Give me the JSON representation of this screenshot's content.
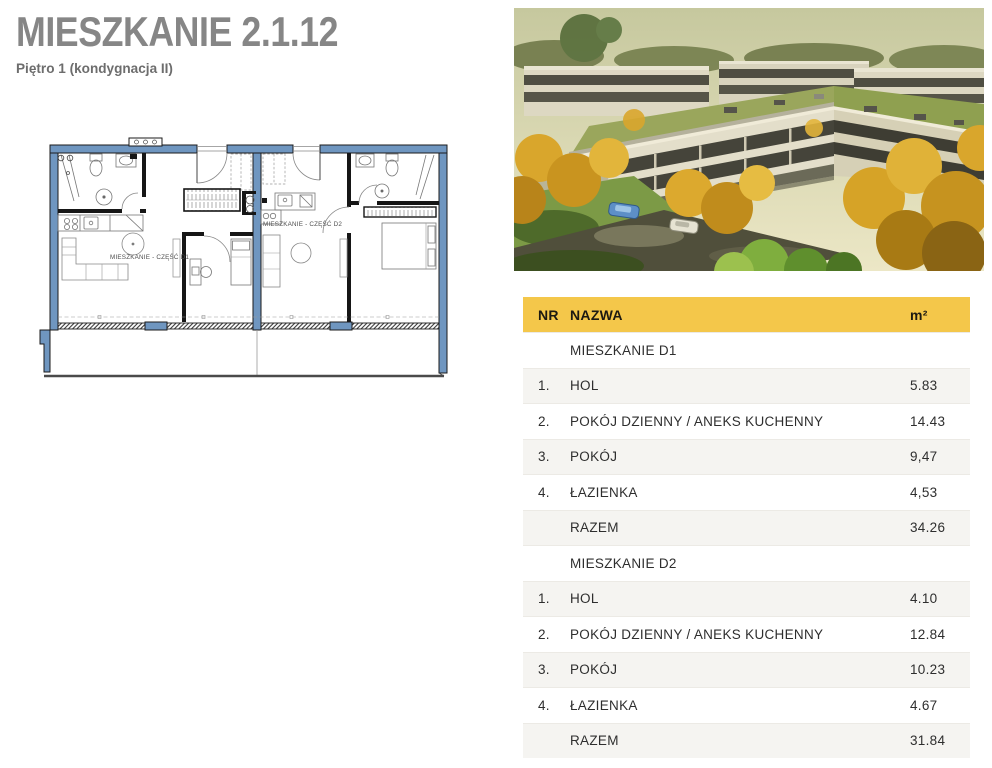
{
  "page": {
    "title": "MIESZKANIE 2.1.12",
    "subtitle": "Piętro 1 (kondygnacja II)"
  },
  "colors": {
    "accent_yellow": "#f4c74a",
    "plan_wall_blue": "#6f96c0",
    "roof_green": "#8fa050"
  },
  "floorplan": {
    "label_d1": "MIESZKANIE - CZĘŚĆ D1",
    "label_d2": "MIESZKANIE - CZĘŚĆ D2"
  },
  "photo": {
    "name": "apartment-complex-aerial-render"
  },
  "table": {
    "columns": [
      "NR",
      "NAZWA",
      "m²"
    ],
    "sections": [
      {
        "name": "MIESZKANIE D1",
        "rows": [
          {
            "nr": "1.",
            "nazwa": "HOL",
            "area": "5.83"
          },
          {
            "nr": "2.",
            "nazwa": "POKÓJ DZIENNY / ANEKS KUCHENNY",
            "area": "14.43"
          },
          {
            "nr": "3.",
            "nazwa": "POKÓJ",
            "area": "9,47"
          },
          {
            "nr": "4.",
            "nazwa": "ŁAZIENKA",
            "area": "4,53"
          }
        ],
        "total_label": "RAZEM",
        "total": "34.26"
      },
      {
        "name": "MIESZKANIE D2",
        "rows": [
          {
            "nr": "1.",
            "nazwa": "HOL",
            "area": "4.10"
          },
          {
            "nr": "2.",
            "nazwa": "POKÓJ DZIENNY / ANEKS KUCHENNY",
            "area": "12.84"
          },
          {
            "nr": "3.",
            "nazwa": "POKÓJ",
            "area": "10.23"
          },
          {
            "nr": "4.",
            "nazwa": "ŁAZIENKA",
            "area": "4.67"
          }
        ],
        "total_label": "RAZEM",
        "total": "31.84"
      }
    ]
  }
}
